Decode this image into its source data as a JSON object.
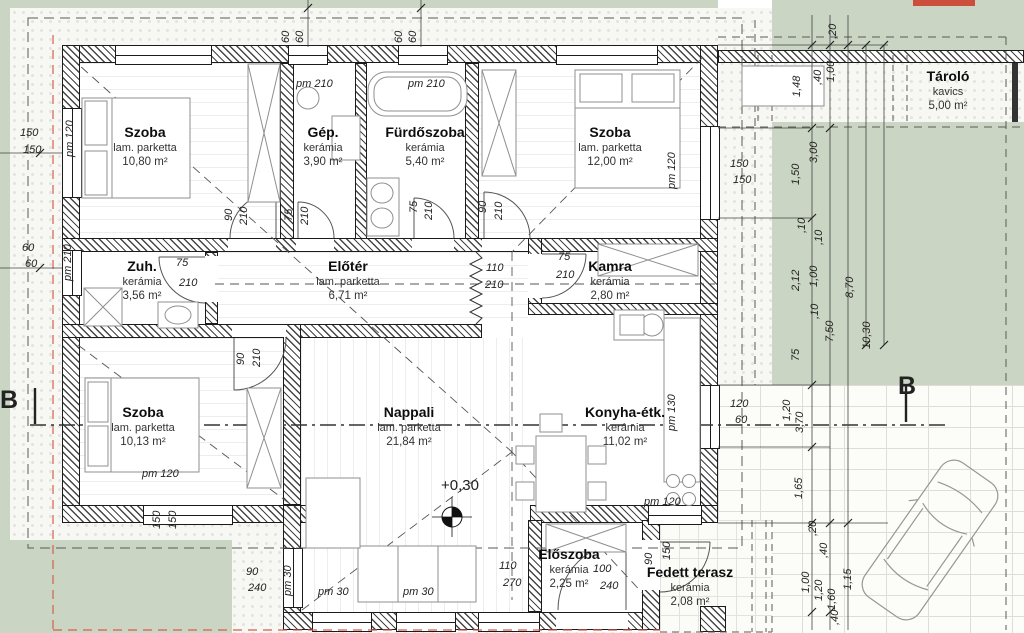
{
  "rooms": {
    "szoba1": {
      "name": "Szoba",
      "floor": "lam. parketta",
      "area": "10,80 m²"
    },
    "gep": {
      "name": "Gép.",
      "floor": "kerámia",
      "area": "3,90 m²"
    },
    "furdoszoba": {
      "name": "Fürdőszoba",
      "floor": "kerámia",
      "area": "5,40 m²"
    },
    "szoba2": {
      "name": "Szoba",
      "floor": "lam. parketta",
      "area": "12,00 m²"
    },
    "zuh": {
      "name": "Zuh.",
      "floor": "kerámia",
      "area": "3,56 m²"
    },
    "eloter": {
      "name": "Előtér",
      "floor": "lam. parketta",
      "area": "6,71 m²"
    },
    "kamra": {
      "name": "Kamra",
      "floor": "kerámia",
      "area": "2,80 m²"
    },
    "szoba3": {
      "name": "Szoba",
      "floor": "lam. parketta",
      "area": "10,13 m²"
    },
    "nappali": {
      "name": "Nappali",
      "floor": "lam. parketta",
      "area": "21,84 m²"
    },
    "konyha": {
      "name": "Konyha-étk.",
      "floor": "kerámia",
      "area": "11,02 m²"
    },
    "eloszoba": {
      "name": "Előszoba",
      "floor": "kerámia",
      "area": "2,25 m²"
    },
    "terasz": {
      "name": "Fedett terasz",
      "floor": "kerámia",
      "area": "2,08 m²"
    },
    "tarolo": {
      "name": "Tároló",
      "floor": "kavics",
      "area": "5,00 m²"
    }
  },
  "level_mark": "+0,30",
  "section_label": "B",
  "doors": {
    "szoba1": [
      "90",
      "210"
    ],
    "gep": [
      "75",
      "210"
    ],
    "furdo": [
      "75",
      "210"
    ],
    "szoba2": [
      "90",
      "210"
    ],
    "zuh": [
      "75",
      "210"
    ],
    "szoba3": [
      "90",
      "210"
    ],
    "kamra": [
      "75",
      "210"
    ],
    "eloter_konyha": [
      "110",
      "210"
    ],
    "terasz_ajto": [
      "90",
      "240"
    ],
    "eloszoba": [
      "100",
      "240"
    ],
    "terasz_oldal": [
      "90",
      "150"
    ]
  },
  "windows": {
    "szoba1_left": [
      "150",
      "150"
    ],
    "zuh_left": [
      "60",
      "60"
    ],
    "vent1": [
      "60",
      "60"
    ],
    "vent2": [
      "60",
      "60"
    ],
    "szoba2_right": [
      "150",
      "150"
    ],
    "konyha_right": [
      "120",
      "60"
    ],
    "szoba3_bottom": [
      "150",
      "150"
    ],
    "nappali_terasz": [
      "110",
      "270"
    ]
  },
  "parapets": {
    "szoba1_left": "pm 120",
    "zuh_left": "pm 210",
    "gep_top": "pm 210",
    "furdo_top": "pm 210",
    "szoba2_right": "pm 120",
    "konyha_right": "pm 130",
    "konyha_bottom": "pm 120",
    "szoba3_bottom": "pm 120",
    "pm30_rot": "pm 30",
    "pm30_a": "pm 30",
    "pm30_b": "pm 30"
  },
  "chains": {
    "right": [
      "1,50",
      "3,00",
      ",10",
      ",10",
      "2,12",
      "1,00",
      "8,70",
      ",10",
      "7,50",
      "10,30",
      "75",
      "1,20",
      "3,70",
      "1,65",
      ",20",
      ",40",
      "1,00",
      "1,20",
      "1,60",
      "1,15",
      ",40"
    ],
    "top": [
      "1,48",
      ",40",
      "1,00",
      ",20"
    ],
    "left": [
      "150",
      "150",
      "60",
      "60"
    ]
  }
}
